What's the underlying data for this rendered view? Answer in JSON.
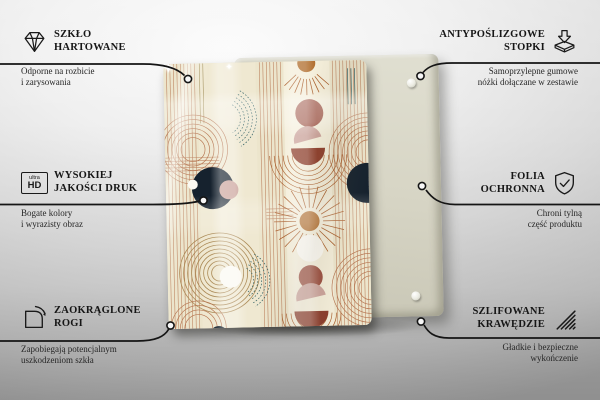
{
  "canvas": {
    "width": 600,
    "height": 400
  },
  "palette": {
    "background_gray": "#dedede",
    "text": "#161616",
    "connector_line": "#151515",
    "glass_cream": "#ece5cc",
    "rust_line": "#b5744f",
    "brick": "#9c5243",
    "dark_rust": "#8a3c2b",
    "blush": "#cba39b",
    "navy": "#16222e",
    "teal": "#2e5f63",
    "olive": "#ab8a56",
    "orange": "#b06c2b",
    "backing_board": "#d7d5c5"
  },
  "callouts": [
    {
      "id": "tempered-glass",
      "side": "left",
      "icon": "diamond-icon",
      "title1": "SZKŁO",
      "title2": "HARTOWANE",
      "desc1": "Odporne na rozbicie",
      "desc2": "i zarysowania"
    },
    {
      "id": "anti-slip-feet",
      "side": "right",
      "icon": "feet-in-box-icon",
      "title1": "ANTYPOŚLIZGOWE",
      "title2": "STOPKI",
      "desc1": "Samoprzylepne gumowe",
      "desc2": "nóżki dołączane w zestawie"
    },
    {
      "id": "print-quality",
      "side": "left",
      "icon": "ultra-hd-icon",
      "hd_top": "ultra",
      "hd_bottom": "HD",
      "title1": "WYSOKIEJ",
      "title2": "JAKOŚCI DRUK",
      "desc1": "Bogate kolory",
      "desc2": "i wyrazisty obraz"
    },
    {
      "id": "protective-film",
      "side": "right",
      "icon": "shield-check-icon",
      "title1": "FOLIA",
      "title2": "OCHRONNA",
      "desc1": "Chroni tylną",
      "desc2": "część produktu"
    },
    {
      "id": "rounded-corners",
      "side": "left",
      "icon": "rounded-corner-icon",
      "title1": "ZAOKRĄGLONE",
      "title2": "ROGI",
      "desc1": "Zapobiegają potencjalnym",
      "desc2": "uszkodzeniom szkła"
    },
    {
      "id": "polished-edges",
      "side": "right",
      "icon": "hatched-edge-icon",
      "title1": "SZLIFOWANE",
      "title2": "KRAWĘDZIE",
      "desc1": "Gładkie i bezpieczne",
      "desc2": "wykończenie"
    }
  ],
  "sparkle_glyph": "✦"
}
